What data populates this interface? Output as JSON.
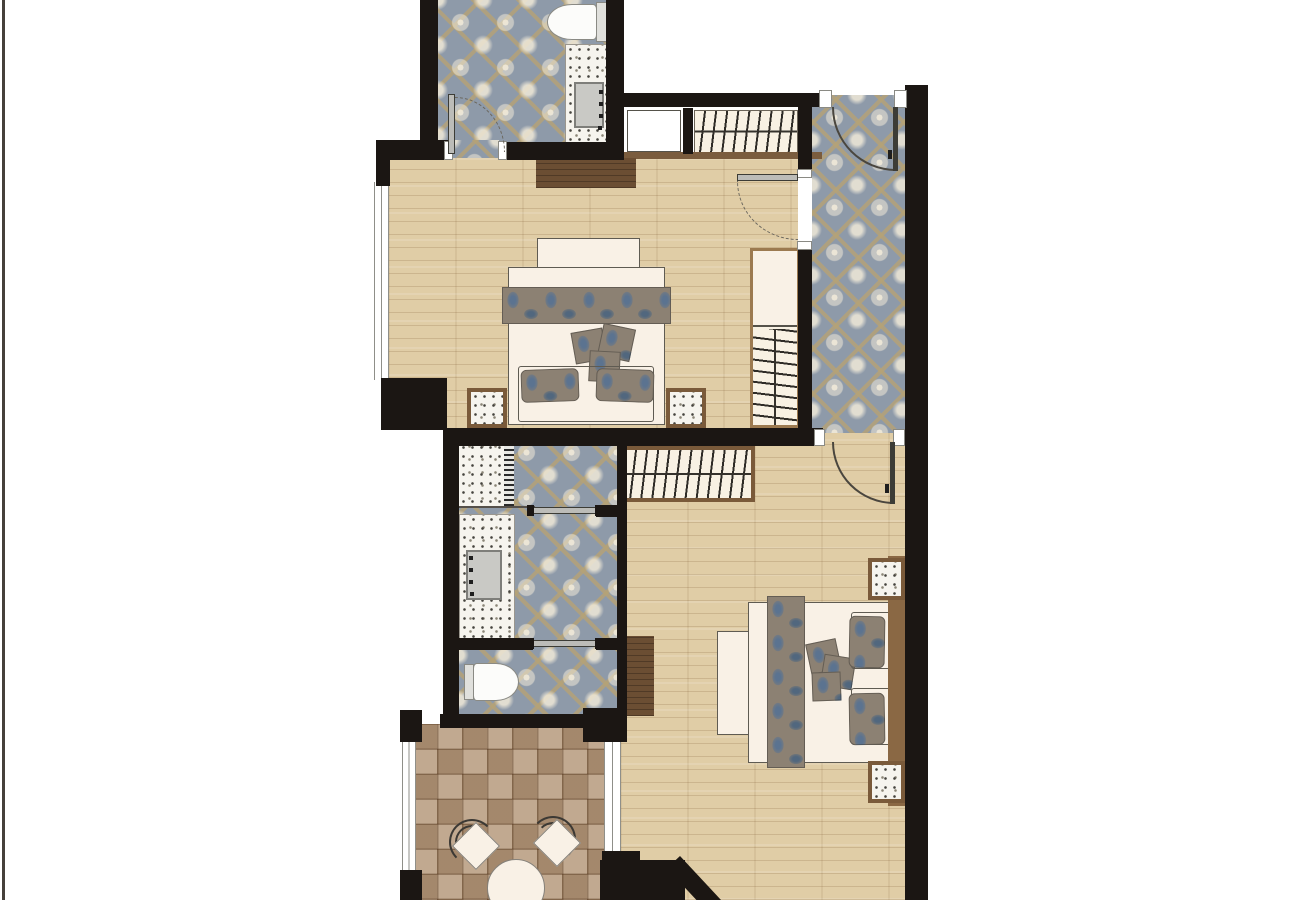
{
  "document": {
    "type": "floor-plan",
    "title": "Two-bedroom suite floor plan",
    "visible_text": []
  },
  "palette": {
    "wall": "#1b1613",
    "wood": "#e0cda6",
    "tile": "#8e9aa9",
    "tile_accent": "#b6a275",
    "tile_motif": "#f0e9d8",
    "terrazzo": "#f6f4ee",
    "marble": "#b5987b",
    "fabric": "#8c8173",
    "fabric_blue": "#5b7390",
    "bedding": "#f9f1e6",
    "darkwood": "#6b4e33",
    "frame": "#7a5a3a",
    "door": "#bcbcb8",
    "border_line": "#46403b"
  },
  "rooms": {
    "bathroom_top": {
      "label": "Bathroom (top) — decorative tile, toilet, vanity sink, swing door"
    },
    "entry_hall": {
      "label": "Entry hall — decorative tile, entry door, doors to both bedrooms"
    },
    "bedroom_1": {
      "label": "Bedroom 1 — wood floor, double bed, runner, cushions, nightstands, wardrobe, closet, console, window"
    },
    "bathroom_middle": {
      "label": "Bathroom (middle) — shower, vanity sink, WC, sliding doors"
    },
    "bedroom_2": {
      "label": "Bedroom 2 — wood floor, double bed, runner, cushions, nightstands, closet, dresser, terrace window"
    },
    "terrace": {
      "label": "Terrace — stone tile, round table, two chairs, windows"
    }
  },
  "counts": {
    "beds": 2,
    "bathrooms": 2,
    "terrace_chairs": 2,
    "hangers_entry_closet": 9,
    "hangers_bedroom2_closet": 11,
    "hangers_wardrobe": 8,
    "nightstands": 4
  }
}
